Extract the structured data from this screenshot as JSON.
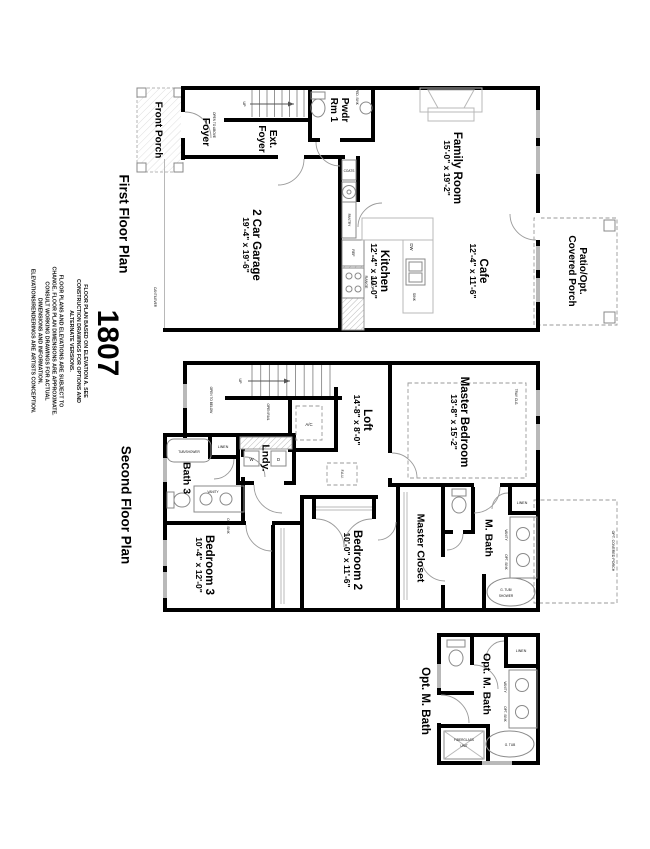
{
  "plan_number": "1807",
  "titles": {
    "first": "First Floor Plan",
    "second": "Second Floor Plan"
  },
  "disclaimer": {
    "p1": "FLOOR PLAN BASED ON ELEVATION A. SEE CONSTRUCTION DRAWINGS FOR OPTIONS AND ALTERNATE VERSIONS.",
    "p2": "FLOOR PLANS AND ELEVATIONS ARE SUBJECT TO CHANGE. FLOOR PLAN DIMENSIONS ARE APPROXIMATE. CONSULT WORKING DRAWINGS FOR ACTUAL DIMENSIONS AND INFORMATION. ELEVATIONS/RENDERINGS ARE ARTISTS CONCEPTION."
  },
  "first_floor": {
    "front_porch": "Front Porch",
    "foyer": "Foyer",
    "ext_foyer_1": "Ext.",
    "ext_foyer_2": "Foyer",
    "pwdr_1": "Pwdr",
    "pwdr_2": "Rm 1",
    "garage_name": "2 Car Garage",
    "garage_dims": "19'-4\" x 19'-6\"",
    "family_name": "Family Room",
    "family_dims": "15'-0\" x 19'-2\"",
    "kitchen_name": "Kitchen",
    "kitchen_dims": "12'-4\" x 10'-0\"",
    "cafe_name": "Cafe",
    "cafe_dims": "12'-4\" x 11'-6\"",
    "patio_1": "Patio/Opt.",
    "patio_2": "Covered Porch",
    "up": "UP",
    "open_above": "OPEN TO ABOVE",
    "coats": "COATS",
    "pantry": "PANTRY",
    "ref": "REF",
    "dw": "DW",
    "sink": "SINK",
    "micro_1": "MICRO",
    "micro_2": "RANGE",
    "ped_sink": "PED. SINK",
    "cantilever": "CANTILEVER"
  },
  "second_floor": {
    "loft_name": "Loft",
    "loft_dims": "14'-8\" x 8'-0\"",
    "master_name": "Master Bedroom",
    "master_dims": "13'-8\" x 15'-2\"",
    "lndy": "Lndy.",
    "bath3": "Bath 3",
    "bed3_name": "Bedroom 3",
    "bed3_dims": "10'-4\" x 12'-0\"",
    "bed2_name": "Bedroom 2",
    "bed2_dims": "10'-0\" x 11'-6\"",
    "mcloset": "Master Closet",
    "mbath": "M. Bath",
    "up": "UP",
    "open_rail": "OPEN RAIL",
    "open_below": "OPEN TO BELOW",
    "ac": "A/C",
    "fau": "F.A.U.",
    "linen": "LINEN",
    "tub_shower": "TUB/SHOWER",
    "vanity": "VANITY",
    "opt_sink": "OPT. SINK",
    "w": "W",
    "d": "D",
    "tray": "TRAY CLG.",
    "gtub_1": "G. TUB/",
    "gtub_2": "SHOWER",
    "opt_porch": "OPT. COVERED PORCH",
    "mb_linen": "LINEN",
    "mb_vanity": "VANITY",
    "mb_opt_sink": "OPT. SINK"
  },
  "opt_mbath": {
    "label": "Opt. M. Bath",
    "inner": "Opt. M. Bath",
    "linen": "LINEN",
    "vanity": "VANITY",
    "opt_sink": "OPT. SINK",
    "gtub": "G. TUB",
    "fiberglass_1": "FIBERGLASS",
    "fiberglass_2": "UNIT"
  },
  "colors": {
    "ink": "#000000",
    "fixture_line": "#8a8a8a",
    "dashed_line": "#9a9a9a"
  }
}
